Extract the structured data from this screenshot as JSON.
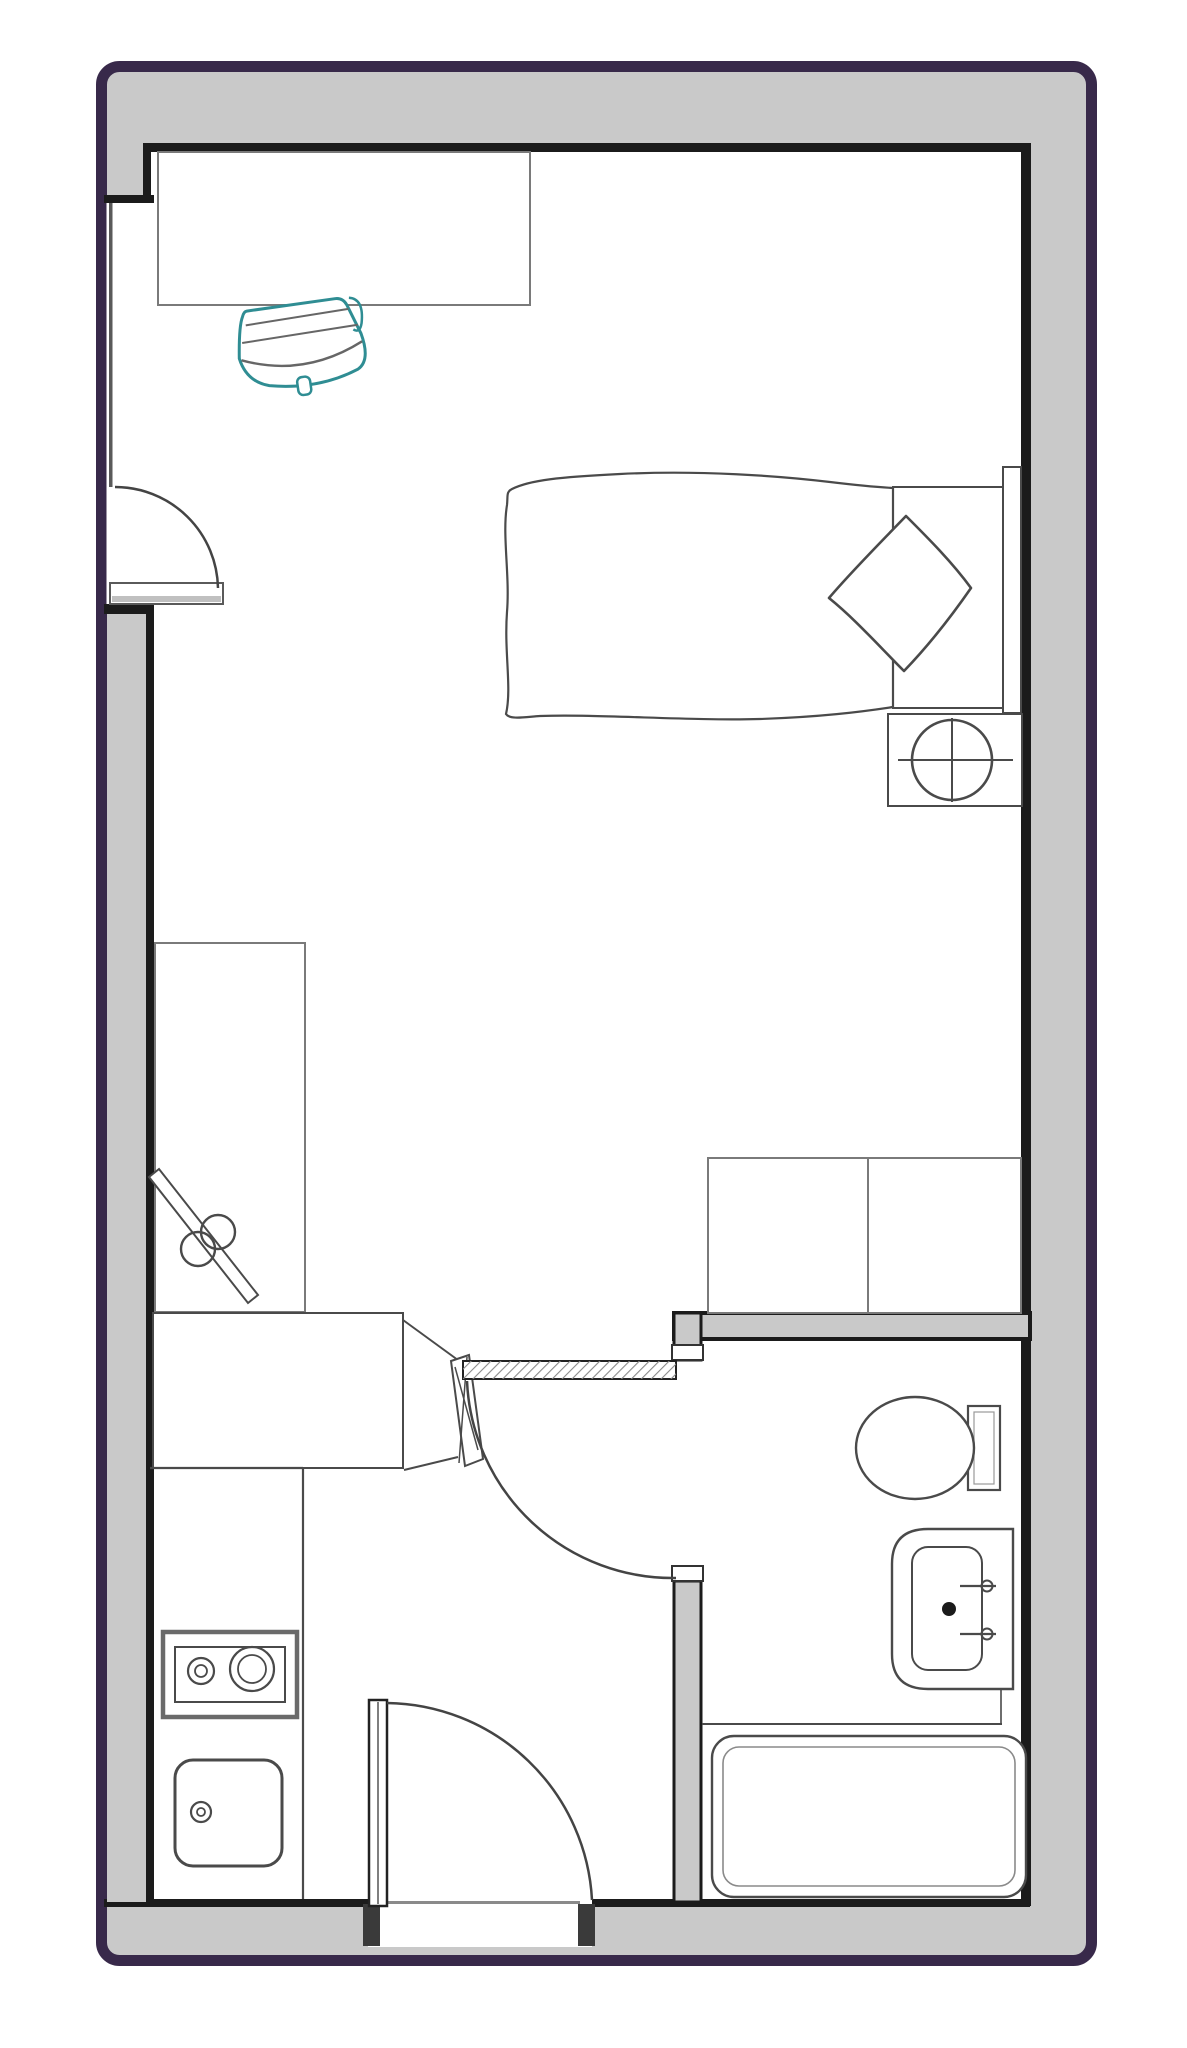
{
  "meta": {
    "title": "Studio apartment floor plan",
    "type": "architectural-floor-plan"
  },
  "colors": {
    "background": "#ffffff",
    "outer_border": "#38294a",
    "wall_fill": "#c9c9c9",
    "wall_line": "#1b1b1b",
    "furniture_line": "#4a4a4a",
    "furniture_line_light": "#7a7a7a",
    "chair_accent": "#2f8d93",
    "floor": "#ffffff"
  },
  "rooms": [
    {
      "name": "main-room",
      "contents": [
        "desk",
        "desk-chair",
        "bed",
        "blanket",
        "pillow",
        "headboard",
        "nightstand-with-lamp",
        "wardrobe-with-hanging-rail",
        "second-desk",
        "folding-chair",
        "bench-units"
      ]
    },
    {
      "name": "kitchenette",
      "contents": [
        "counter",
        "two-burner-cooktop",
        "kitchen-sink"
      ]
    },
    {
      "name": "bathroom",
      "contents": [
        "toilet",
        "wash-basin",
        "bathtub"
      ]
    }
  ],
  "doors": [
    {
      "name": "left-wall-door",
      "swing": "quarter-arc"
    },
    {
      "name": "bathroom-door",
      "swing": "quarter-arc"
    },
    {
      "name": "entry-door",
      "swing": "quarter-arc"
    }
  ]
}
